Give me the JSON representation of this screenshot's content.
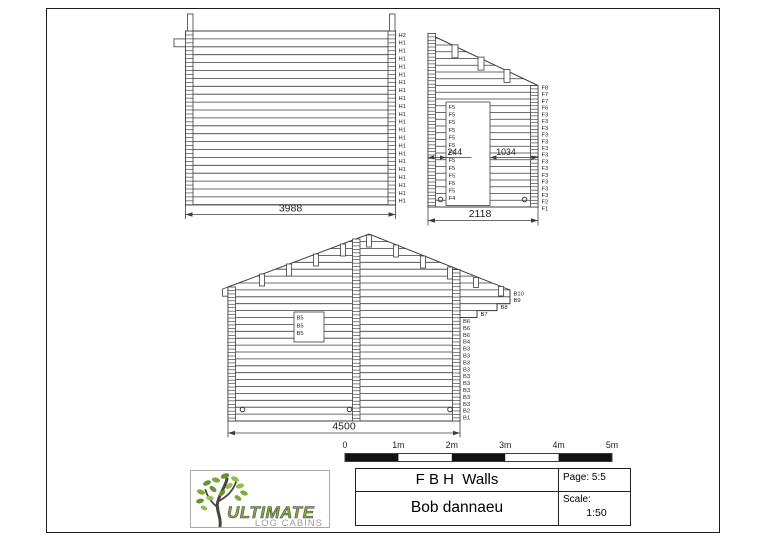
{
  "colors": {
    "line": "#3c3c3c",
    "text": "#1e1e1e",
    "green": "#7cab3b",
    "leafdark": "#5f9430",
    "leaflight": "#8fc04f",
    "trunk": "#4b4339",
    "lgray": "#9b9b9b",
    "scalebar": "#111111"
  },
  "walls": {
    "h": {
      "labels": [
        "H2",
        "H1",
        "H1",
        "H1",
        "H1",
        "H1",
        "H1",
        "H1",
        "H1",
        "H1",
        "H1",
        "H1",
        "H1",
        "H1",
        "H1",
        "H1",
        "H1",
        "H1",
        "H1",
        "H1",
        "H1",
        "H1"
      ],
      "dim": "3988"
    },
    "f": {
      "right_labels": [
        "F8",
        "F7",
        "F7",
        "F6",
        "F3",
        "F3",
        "F3",
        "F3",
        "F3",
        "F3",
        "F3",
        "F3",
        "F3",
        "F3",
        "F3",
        "F3",
        "F3",
        "F2",
        "F1"
      ],
      "door_labels": [
        "F5",
        "F5",
        "F5",
        "F5",
        "F5",
        "F5",
        "F5",
        "F5",
        "F5",
        "F5",
        "F5",
        "F5",
        "F4"
      ],
      "dim_left": "244",
      "dim_right": "1034",
      "dim_total": "2118"
    },
    "b": {
      "overhang_labels": [
        "B10",
        "B9",
        "B8",
        "B7"
      ],
      "right_labels": [
        "B6",
        "B6",
        "B6",
        "B4",
        "B3",
        "B3",
        "B3",
        "B3",
        "B3",
        "B3",
        "B3",
        "B3",
        "B3",
        "B2",
        "B1"
      ],
      "window_labels": [
        "B5",
        "B5",
        "B5"
      ],
      "dim": "4500"
    }
  },
  "scale_bar": {
    "labels": [
      "0",
      "1m",
      "2m",
      "3m",
      "4m",
      "5m"
    ]
  },
  "logo": {
    "brand": "ULTIMATE",
    "subtitle": "LOG CABINS"
  },
  "title_block": {
    "title": "F B H  Walls",
    "client": "Bob dannaeu",
    "page": "Page: 5:5",
    "scale_label": "Scale:",
    "scale_value": "1:50"
  }
}
